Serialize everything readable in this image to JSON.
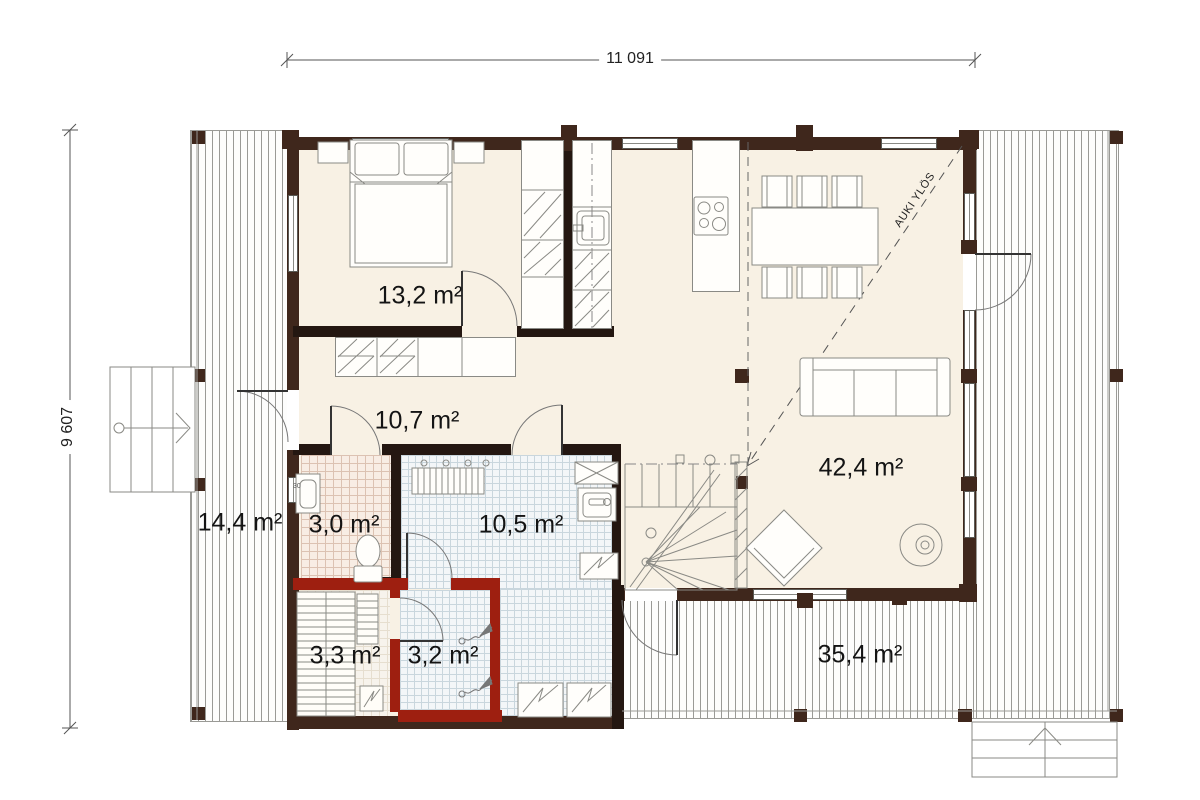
{
  "dimensions": {
    "top": "11 091",
    "left": "9 607"
  },
  "rooms": [
    {
      "id": "bedroom",
      "area": "13,2 m²"
    },
    {
      "id": "hallway",
      "area": "10,7 m²"
    },
    {
      "id": "living-room",
      "area": "42,4 m²"
    },
    {
      "id": "wc",
      "area": "3,0 m²"
    },
    {
      "id": "bathroom",
      "area": "10,5 m²"
    },
    {
      "id": "sauna",
      "area": "3,3 m²"
    },
    {
      "id": "shower-room",
      "area": "3,2 m²"
    },
    {
      "id": "terrace-left",
      "area": "14,4 m²"
    },
    {
      "id": "terrace-right",
      "area": "35,4 m²"
    }
  ],
  "annotations": {
    "open_above": "AUKI YLÖS",
    "basin_size": "30"
  },
  "colors": {
    "exterior_wall": "#3f271c",
    "interior_wall": "#241711",
    "sauna_wall": "#9e1f10",
    "floor": "#f8f1e4",
    "wet_tile": "#f3f6f8",
    "wc_tile": "#f8ede4",
    "deck_stripe": "#9a9a96"
  }
}
